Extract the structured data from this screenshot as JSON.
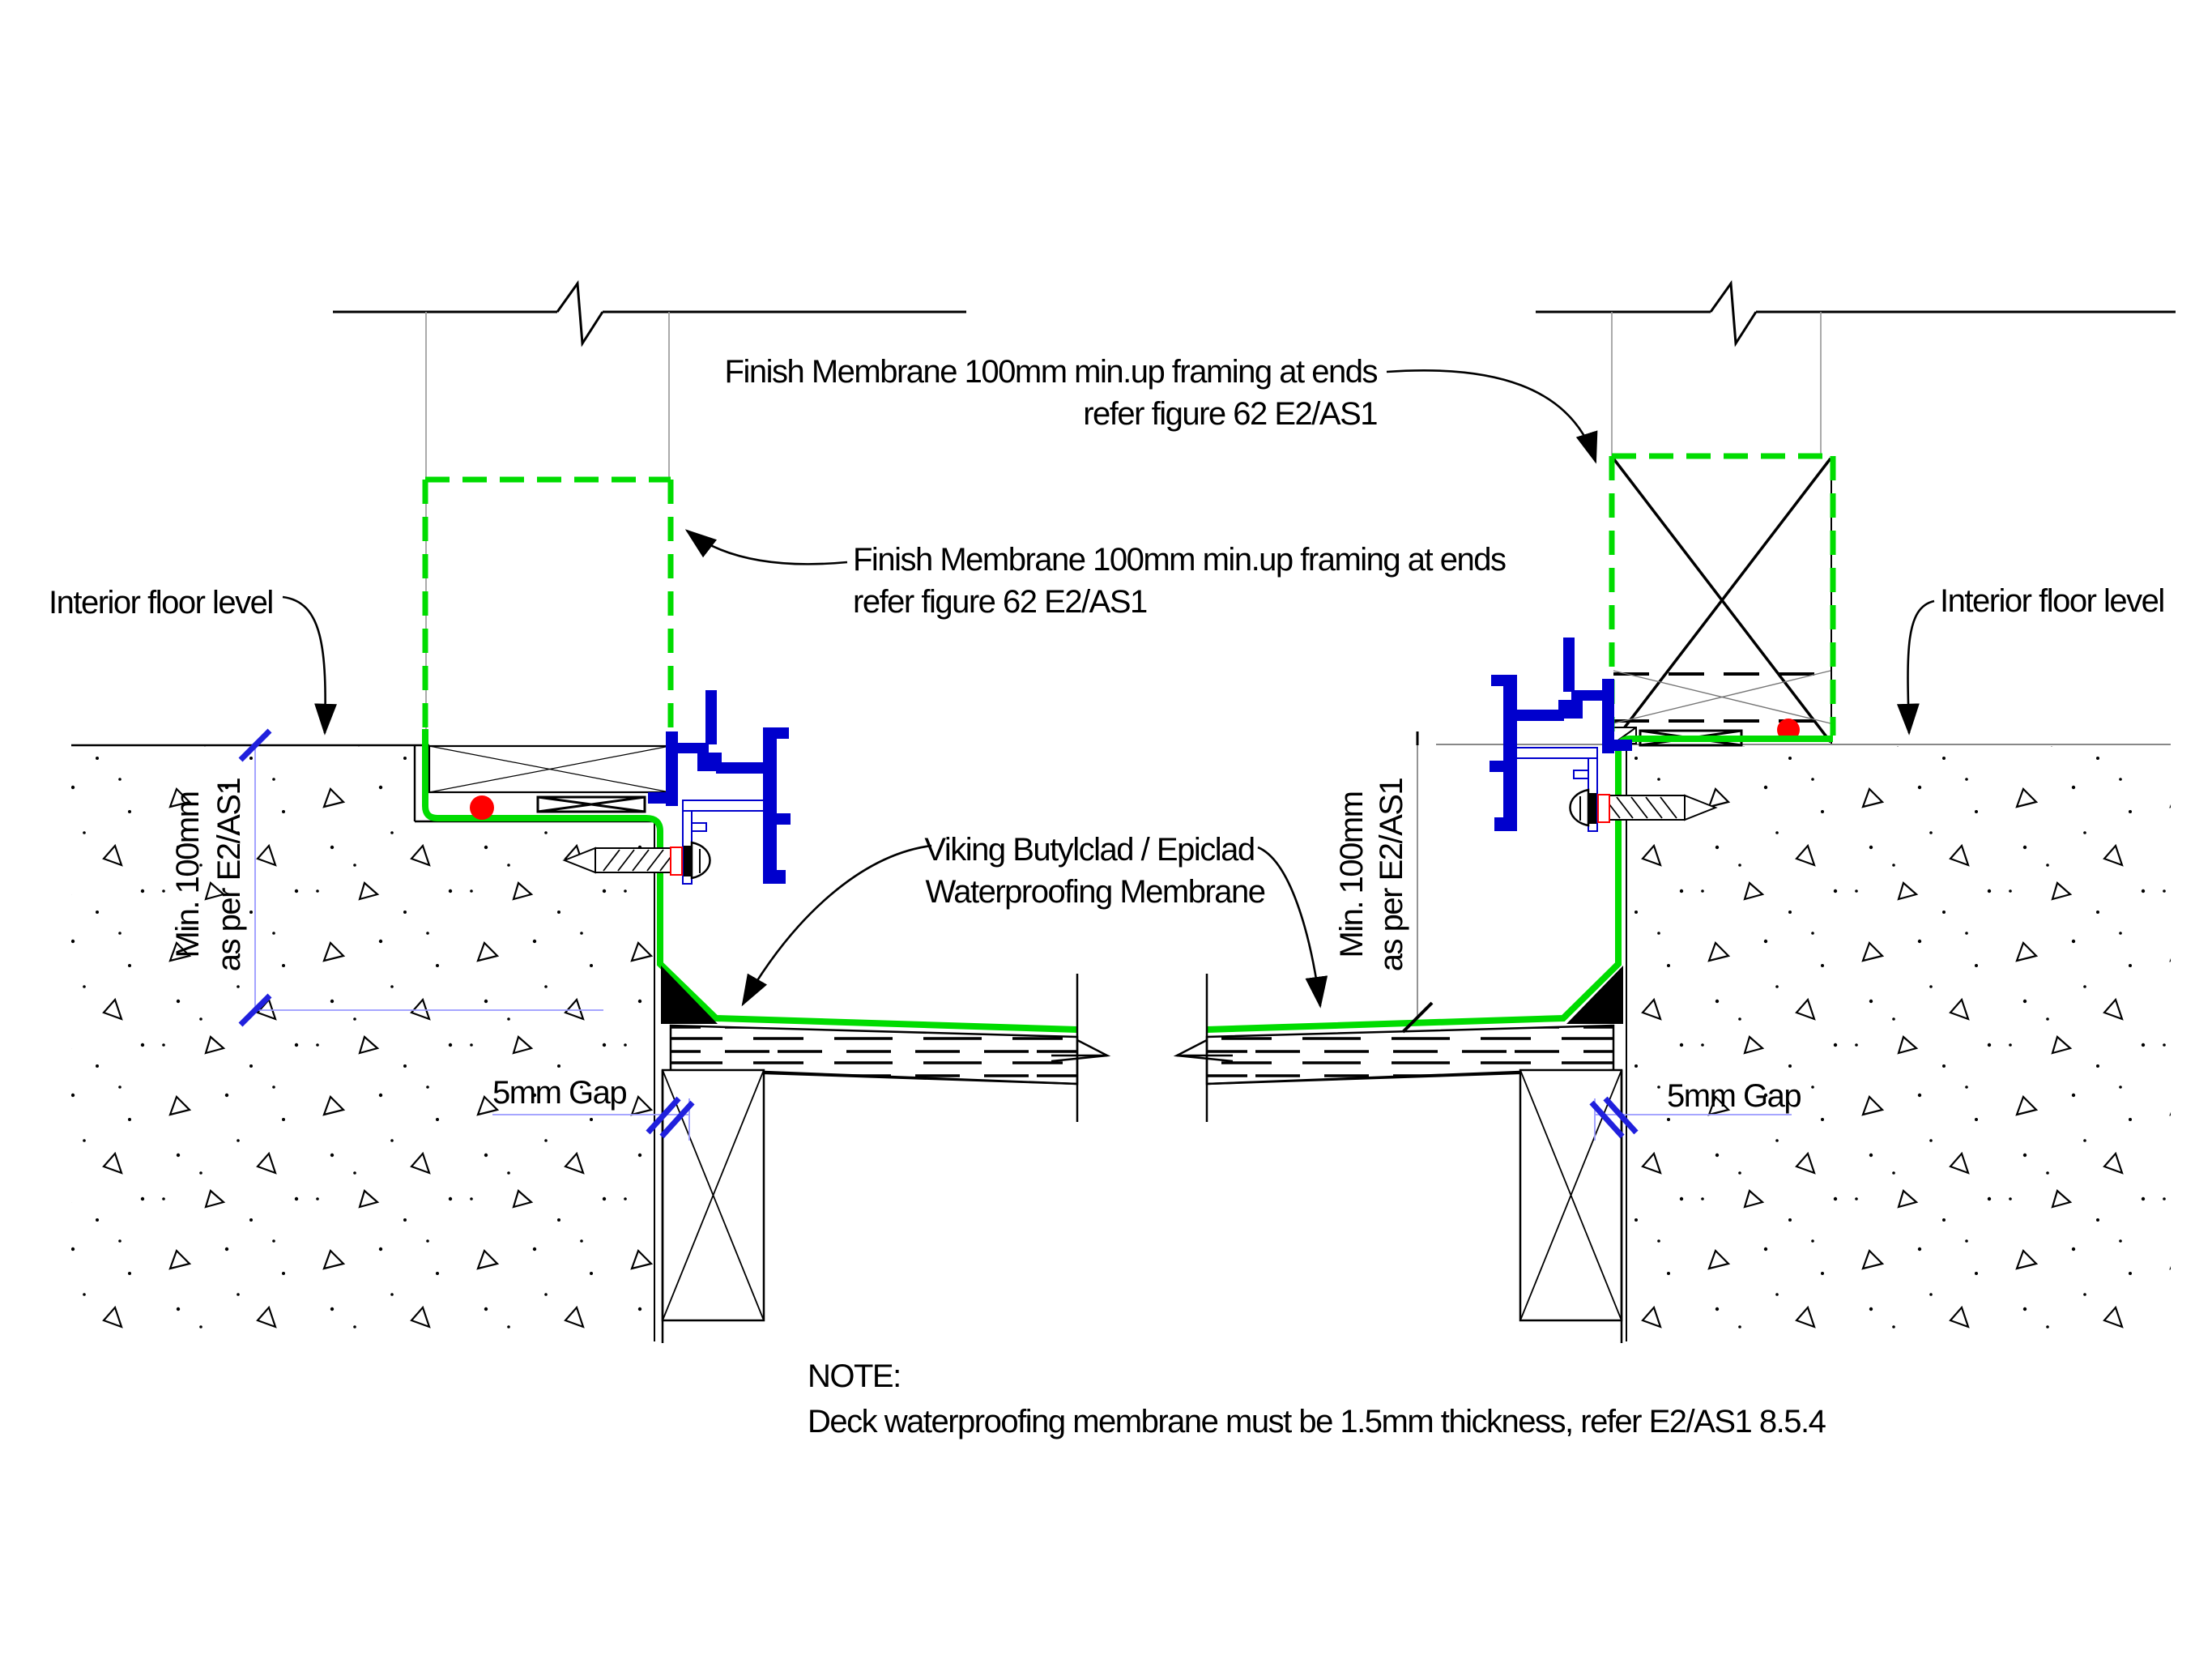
{
  "colors": {
    "membrane": "#00dc00",
    "frame": "#0000cd",
    "red": "#ff0000",
    "dim": "#9a9aff",
    "tick": "#2020dd",
    "gray": "#9c9c9c",
    "ink": "#000000"
  },
  "annotations": {
    "finish_membrane_top": {
      "line1": "Finish Membrane 100mm min.up framing at ends",
      "line2": "refer figure 62 E2/AS1"
    },
    "finish_membrane_mid": {
      "line1": "Finish Membrane 100mm min.up framing at ends",
      "line2": "refer figure 62 E2/AS1"
    },
    "interior_floor_left": "Interior floor level",
    "interior_floor_right": "Interior floor level",
    "min_height_left": {
      "line1": "Min. 100mm",
      "line2": "as per E2/AS1"
    },
    "min_height_right": {
      "line1": "Min. 100mm",
      "line2": "as per E2/AS1"
    },
    "gap_left": "5mm Gap",
    "gap_right": "5mm Gap",
    "membrane_product": {
      "line1": "Viking Butylclad / Epiclad",
      "line2": "Waterproofing Membrane"
    },
    "note": {
      "heading": "NOTE:",
      "body": "Deck waterproofing membrane must be 1.5mm thickness, refer E2/AS1 8.5.4"
    }
  }
}
